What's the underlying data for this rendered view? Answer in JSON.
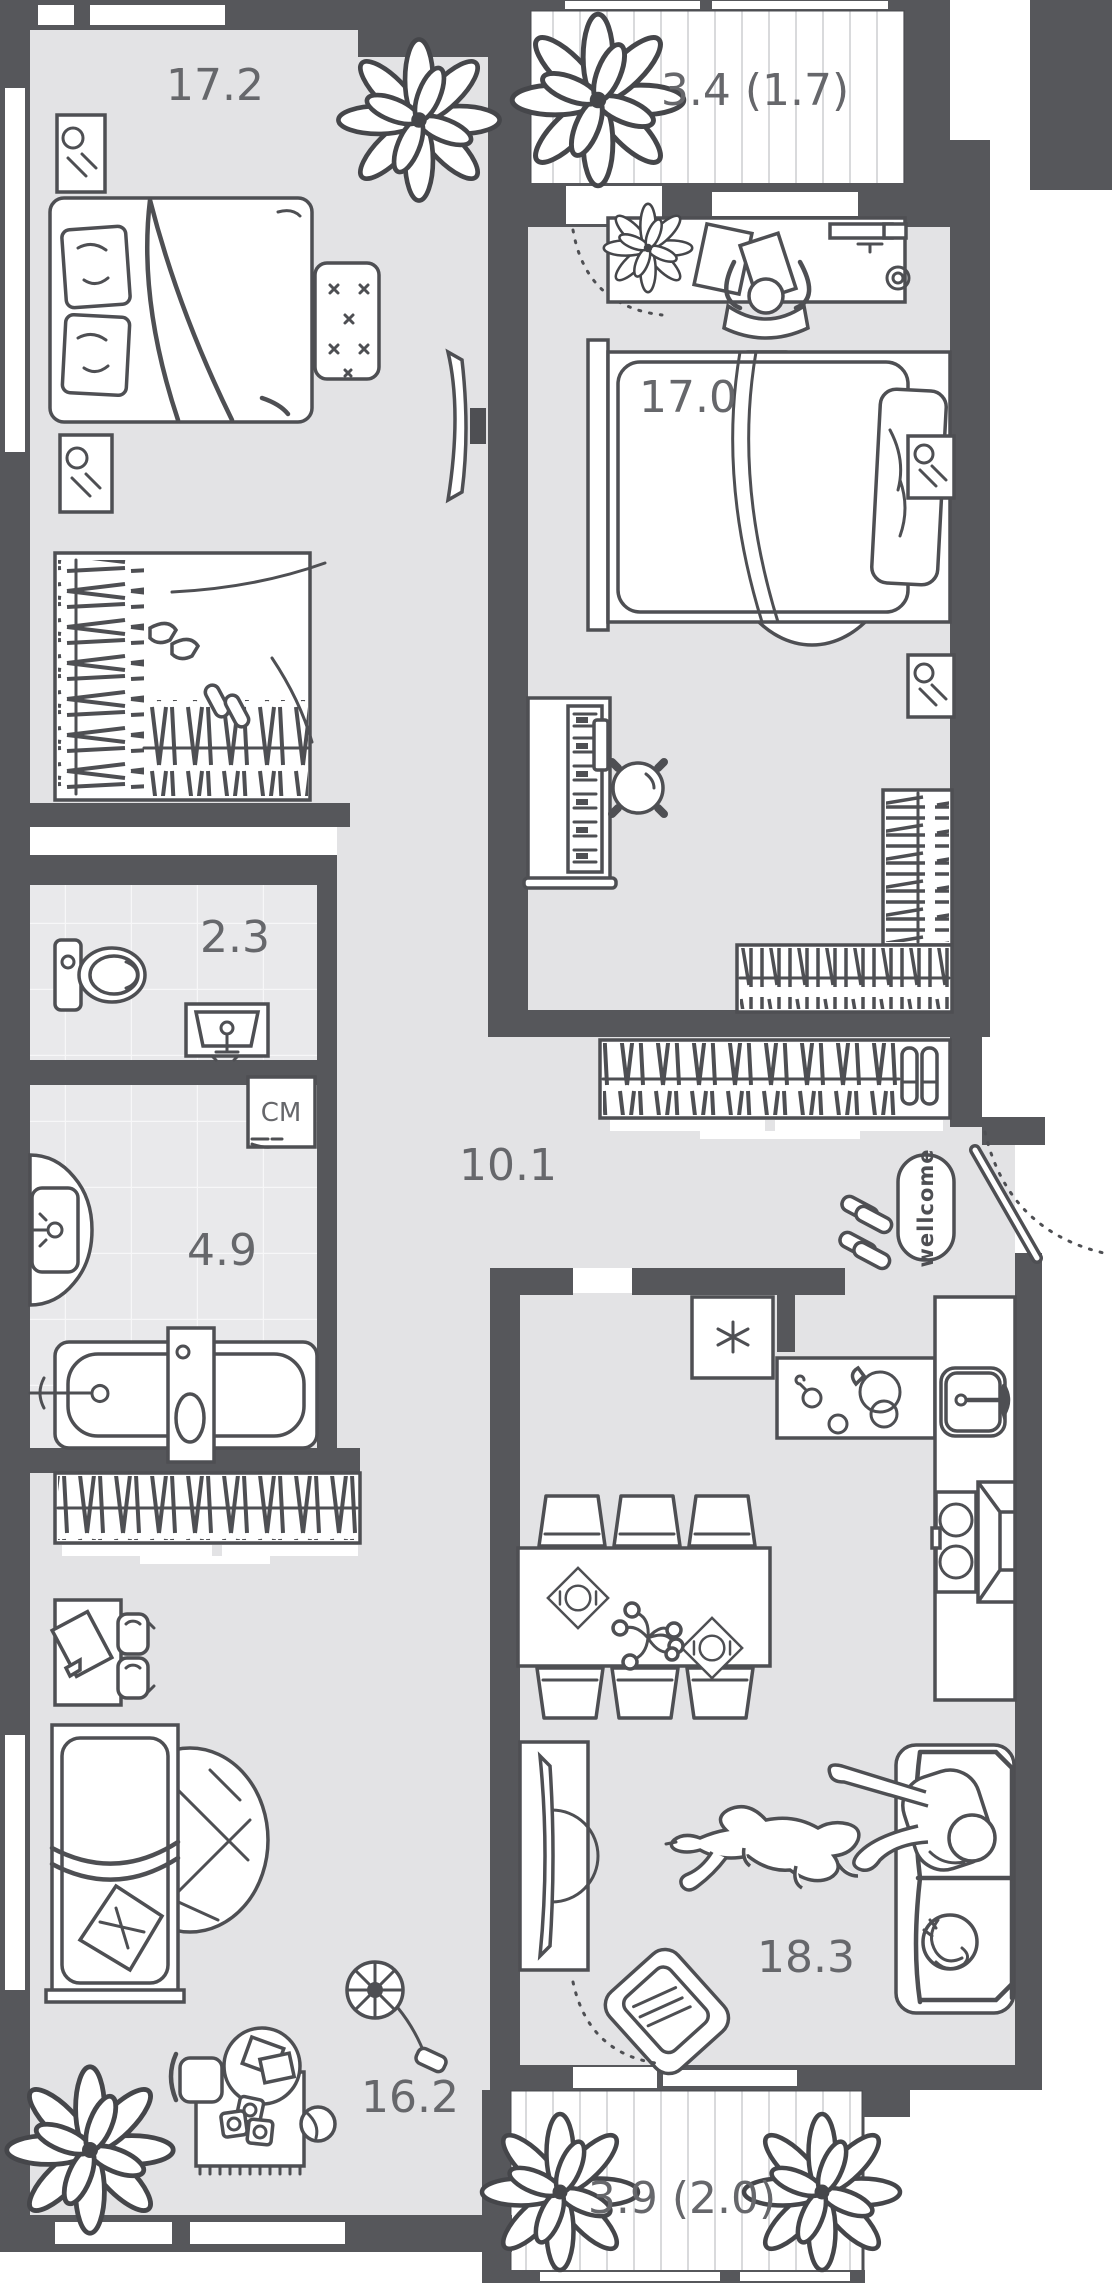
{
  "plan": {
    "type": "apartment-floorplan",
    "labels": {
      "bedroom": "17.2",
      "balcony_top": "3.4 (1.7)",
      "office": "17.0",
      "wc": "2.3",
      "bath": "4.9",
      "hall": "10.1",
      "washer": "СМ",
      "mat": "wellcome",
      "kid": "16.2",
      "living": "18.3",
      "balcony_bottom": "3.9 (2.0)"
    },
    "rooms": [
      {
        "id": "bedroom",
        "area": "17.2"
      },
      {
        "id": "balcony-top",
        "area": "3.4",
        "extra": "(1.7)"
      },
      {
        "id": "office",
        "area": "17.0"
      },
      {
        "id": "wc",
        "area": "2.3"
      },
      {
        "id": "bathroom",
        "area": "4.9"
      },
      {
        "id": "hallway",
        "area": "10.1"
      },
      {
        "id": "kid-room",
        "area": "16.2"
      },
      {
        "id": "living-kitchen",
        "area": "18.3"
      },
      {
        "id": "balcony-bottom",
        "area": "3.9",
        "extra": "(2.0)"
      }
    ],
    "colors": {
      "wall": "#56575b",
      "floor": "#e3e3e5",
      "line": "#4e4f53",
      "label": "#66676b",
      "tile": "#e9e9eb",
      "grout": "#f7f7f8",
      "deckline": "#d9dadc"
    }
  }
}
